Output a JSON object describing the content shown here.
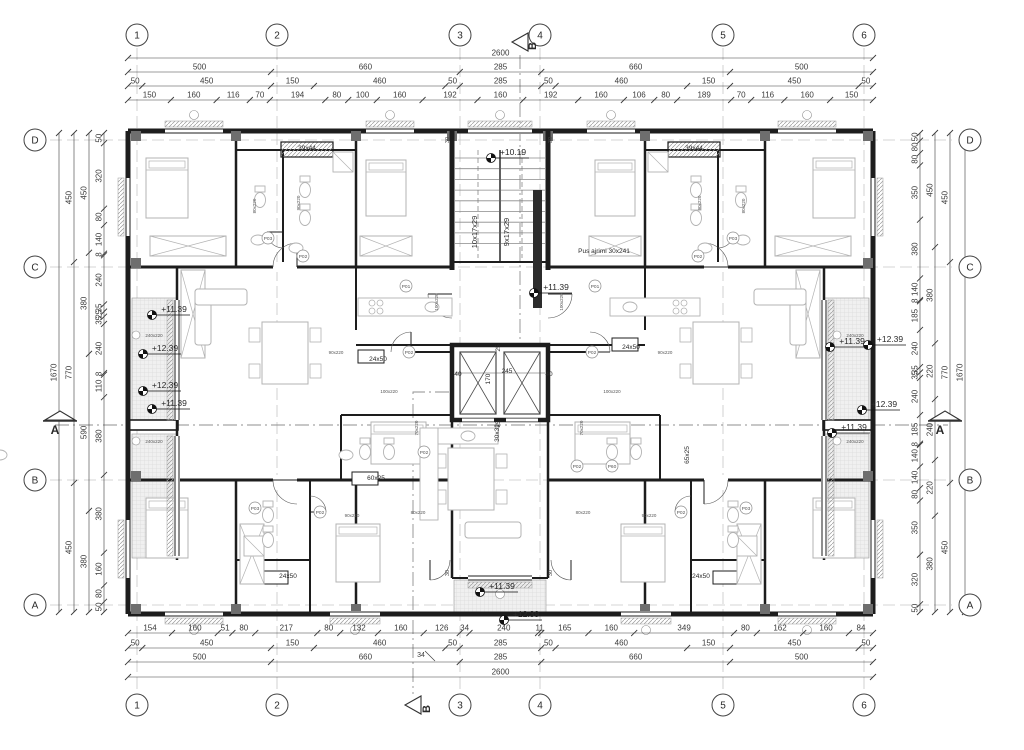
{
  "drawing": {
    "kind": "residential floor plan",
    "colors": {
      "wall": "#1d1d1d",
      "dim": "#3a3a3a",
      "text": "#2a2a2a",
      "furniture": "#b3b3b3",
      "hatch": "#9a9a9a",
      "grid_line": "#c6c6c6"
    }
  },
  "grid": {
    "columns": [
      {
        "label": "1",
        "x": 137
      },
      {
        "label": "2",
        "x": 277
      },
      {
        "label": "3",
        "x": 460
      },
      {
        "label": "4",
        "x": 540
      },
      {
        "label": "5",
        "x": 723
      },
      {
        "label": "6",
        "x": 864
      }
    ],
    "rows": [
      {
        "label": "D",
        "y": 140
      },
      {
        "label": "C",
        "y": 267
      },
      {
        "label": "B",
        "y": 480
      },
      {
        "label": "A",
        "y": 605
      }
    ]
  },
  "sections": {
    "b_top": {
      "label": "B",
      "x": 520,
      "y": 42
    },
    "b_bottom": {
      "label": "B",
      "x": 413,
      "y": 705
    },
    "a_left": {
      "label": "A",
      "x": 60,
      "y": 425
    },
    "a_right": {
      "label": "A",
      "x": 945,
      "y": 425
    }
  },
  "dimensions": {
    "top": [
      {
        "y": 58,
        "values": [
          "2600"
        ]
      },
      {
        "y": 72,
        "values": [
          "500",
          "660",
          "285",
          "660",
          "500"
        ]
      },
      {
        "y": 86,
        "values": [
          "50",
          "450",
          "150",
          "460",
          "50",
          "285",
          "50",
          "460",
          "150",
          "450",
          "50"
        ]
      },
      {
        "y": 100,
        "values": [
          "150",
          "160",
          "116",
          "70",
          "194",
          "80",
          "100",
          "160",
          "192",
          "160",
          "192",
          "160",
          "106",
          "80",
          "189",
          "70",
          "116",
          "160",
          "150"
        ]
      }
    ],
    "bottom": [
      {
        "y": 633,
        "values": [
          "154",
          "160",
          "51",
          "80",
          "217",
          "80",
          "132",
          "160",
          "126",
          "34",
          "240",
          "11",
          "165",
          "160",
          "349",
          "80",
          "162",
          "160",
          "84"
        ]
      },
      {
        "y": 648,
        "values": [
          "50",
          "450",
          "150",
          "460",
          "50",
          "285",
          "50",
          "460",
          "150",
          "450",
          "50"
        ]
      },
      {
        "y": 662,
        "values": [
          "500",
          "660",
          "285",
          "660",
          "500"
        ]
      },
      {
        "y": 677,
        "values": [
          "2600"
        ]
      }
    ],
    "left": [
      {
        "x": 104,
        "values": [
          "50",
          "320",
          "80",
          "140",
          "8",
          "240",
          "35",
          "25",
          "35",
          "240",
          "8",
          "110",
          "380",
          "380",
          "160",
          "80",
          "50"
        ]
      },
      {
        "x": 89,
        "values": [
          "450",
          "380",
          "590",
          "380"
        ]
      },
      {
        "x": 74,
        "values": [
          "450",
          "770",
          "450"
        ]
      },
      {
        "x": 59,
        "values": [
          "1670"
        ]
      }
    ],
    "right": [
      {
        "x": 920,
        "values": [
          "50",
          "80",
          "80",
          "350",
          "380",
          "140",
          "8",
          "185",
          "240",
          "35",
          "35",
          "240",
          "185",
          "8",
          "140",
          "140",
          "80",
          "350",
          "320",
          "50"
        ]
      },
      {
        "x": 935,
        "values": [
          "450",
          "380",
          "220",
          "240",
          "220",
          "380"
        ]
      },
      {
        "x": 950,
        "values": [
          "450",
          "770",
          "450"
        ]
      },
      {
        "x": 965,
        "values": [
          "1670"
        ]
      }
    ],
    "leader_note": {
      "label": "34",
      "x": 421,
      "y": 657
    }
  },
  "annotations": {
    "elevations": [
      {
        "label": "+10.19",
        "x": 497,
        "y": 156
      },
      {
        "label": "+11.39",
        "x": 540,
        "y": 291
      },
      {
        "label": "+11.39",
        "x": 158,
        "y": 313
      },
      {
        "label": "+12.39",
        "x": 149,
        "y": 352
      },
      {
        "label": "+12.39",
        "x": 149,
        "y": 389
      },
      {
        "label": "+11.39",
        "x": 158,
        "y": 407
      },
      {
        "label": "+11.39",
        "x": 836,
        "y": 345
      },
      {
        "label": "+12.39",
        "x": 874,
        "y": 343
      },
      {
        "label": "+12.39",
        "x": 868,
        "y": 408
      },
      {
        "label": "+11.39",
        "x": 838,
        "y": 431
      },
      {
        "label": "+11.39",
        "x": 486,
        "y": 590
      },
      {
        "label": "+12.39",
        "x": 510,
        "y": 618
      }
    ],
    "shafts": [
      {
        "label": "39x44",
        "x": 307,
        "y": 150
      },
      {
        "label": "39x44",
        "x": 694,
        "y": 150
      },
      {
        "label": "24x50",
        "x": 378,
        "y": 361
      },
      {
        "label": "24x50",
        "x": 631,
        "y": 349
      },
      {
        "label": "24x50",
        "x": 288,
        "y": 578
      },
      {
        "label": "24x50",
        "x": 701,
        "y": 578
      },
      {
        "label": "60x25",
        "x": 376,
        "y": 480
      },
      {
        "label": "65x25",
        "x": 689,
        "y": 455,
        "rot": -90
      },
      {
        "label": "30x32",
        "x": 499,
        "y": 433,
        "rot": -90
      }
    ],
    "stairs": [
      {
        "label": "10x17x29",
        "x": 477,
        "y": 232,
        "rot": -90
      },
      {
        "label": "9x17x29",
        "x": 509,
        "y": 232,
        "rot": -90
      }
    ],
    "core_texts": [
      {
        "label": "Pus ajrimi  30x241",
        "x": 604,
        "y": 253
      }
    ],
    "elevator_dims": [
      {
        "label": "40",
        "x": 458,
        "y": 376
      },
      {
        "label": "170",
        "x": 490,
        "y": 379,
        "rot": -90
      },
      {
        "label": "245",
        "x": 507,
        "y": 373
      },
      {
        "label": "40",
        "x": 549,
        "y": 376
      },
      {
        "label": "25",
        "x": 500,
        "y": 348,
        "rot": -90
      },
      {
        "label": "25",
        "x": 500,
        "y": 424,
        "rot": -90
      }
    ],
    "door_tags": [
      {
        "label": "P03",
        "x": 268,
        "y": 238
      },
      {
        "label": "P03",
        "x": 733,
        "y": 238
      },
      {
        "label": "P02",
        "x": 303,
        "y": 256
      },
      {
        "label": "P02",
        "x": 698,
        "y": 256
      },
      {
        "label": "P01",
        "x": 406,
        "y": 286
      },
      {
        "label": "P01",
        "x": 595,
        "y": 286
      },
      {
        "label": "P02",
        "x": 409,
        "y": 352
      },
      {
        "label": "P02",
        "x": 592,
        "y": 352
      },
      {
        "label": "P02",
        "x": 424,
        "y": 452
      },
      {
        "label": "P60",
        "x": 612,
        "y": 466
      },
      {
        "label": "P02",
        "x": 577,
        "y": 466
      },
      {
        "label": "P03",
        "x": 255,
        "y": 508
      },
      {
        "label": "P03",
        "x": 746,
        "y": 508
      },
      {
        "label": "P02",
        "x": 320,
        "y": 512
      },
      {
        "label": "P02",
        "x": 681,
        "y": 512
      }
    ],
    "door_sizes": [
      {
        "label": "90x220",
        "x": 336,
        "y": 354
      },
      {
        "label": "90x220",
        "x": 665,
        "y": 354
      },
      {
        "label": "90x220",
        "x": 300,
        "y": 203,
        "rot": -90
      },
      {
        "label": "90x220",
        "x": 701,
        "y": 203,
        "rot": -90
      },
      {
        "label": "90x220",
        "x": 352,
        "y": 517
      },
      {
        "label": "90x220",
        "x": 649,
        "y": 517
      },
      {
        "label": "80x220",
        "x": 256,
        "y": 206,
        "rot": -90
      },
      {
        "label": "80x220",
        "x": 745,
        "y": 206,
        "rot": -90
      },
      {
        "label": "80x220",
        "x": 583,
        "y": 514
      },
      {
        "label": "80x220",
        "x": 418,
        "y": 514
      },
      {
        "label": "100x220",
        "x": 612,
        "y": 393
      },
      {
        "label": "100x220",
        "x": 389,
        "y": 393
      },
      {
        "label": "100x220",
        "x": 563,
        "y": 302,
        "rot": -90
      },
      {
        "label": "100x220",
        "x": 438,
        "y": 302,
        "rot": -90
      },
      {
        "label": "70x220",
        "x": 583,
        "y": 428,
        "rot": -90
      },
      {
        "label": "70x220",
        "x": 418,
        "y": 428,
        "rot": -90
      }
    ],
    "window_labels": [
      {
        "label": "240x220",
        "x": 150,
        "y": 337,
        "rot": 0
      },
      {
        "label": "240x220",
        "x": 150,
        "y": 443,
        "rot": 0
      },
      {
        "label": "240x220",
        "x": 851,
        "y": 337,
        "rot": 0
      },
      {
        "label": "240x220",
        "x": 851,
        "y": 443,
        "rot": 0
      }
    ],
    "small_notes": [
      {
        "label": "30",
        "x": 449,
        "y": 573,
        "rot": -90
      },
      {
        "label": "30",
        "x": 552,
        "y": 573,
        "rot": -90
      },
      {
        "label": "30",
        "x": 449,
        "y": 140,
        "rot": -90
      },
      {
        "label": "30",
        "x": 552,
        "y": 140,
        "rot": -90
      }
    ]
  }
}
